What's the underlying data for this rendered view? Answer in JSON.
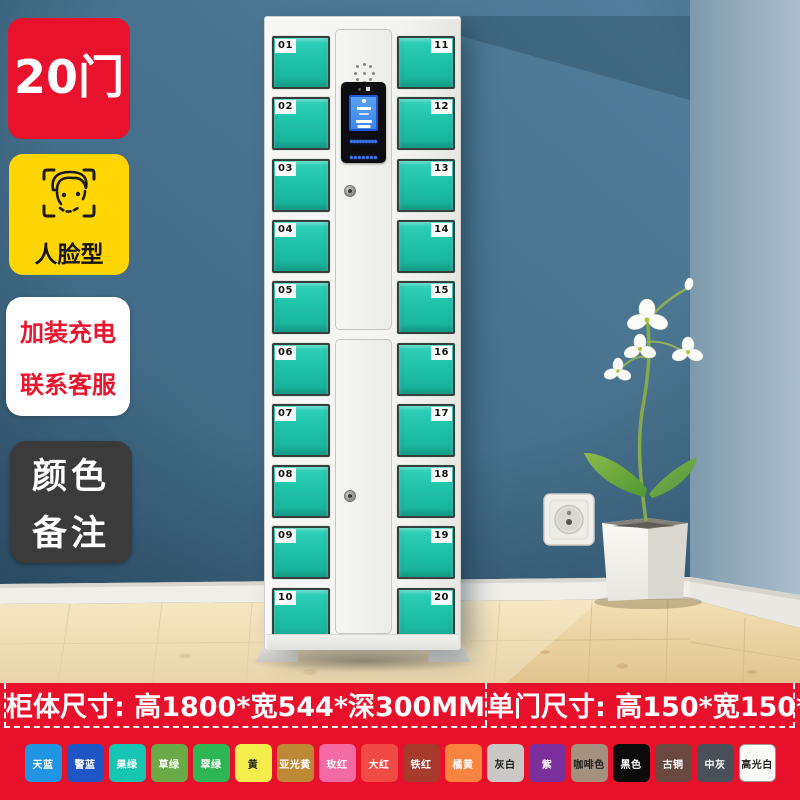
{
  "badges": {
    "door_count": "20门",
    "face_type": "人脸型",
    "service_line1": "加装充电",
    "service_line2": "联系客服",
    "color_note_line1": "颜色",
    "color_note_line2": "备注"
  },
  "locker": {
    "left_door_numbers": [
      "01",
      "02",
      "03",
      "04",
      "05",
      "06",
      "07",
      "08",
      "09",
      "10"
    ],
    "right_door_numbers": [
      "11",
      "12",
      "13",
      "14",
      "15",
      "16",
      "17",
      "18",
      "19",
      "20"
    ],
    "door_color": "#1FC3AA",
    "screen_color": "#4E9AF2",
    "keypad_rows": 4,
    "keypad_cols": 4
  },
  "size_banner": {
    "background_color": "#E8112C",
    "cabinet_size": "柜体尺寸: 高1800*宽544*深300MM",
    "door_size": "单门尺寸: 高150*宽150*深300MM"
  },
  "color_options": [
    {
      "name": "天蓝",
      "hex": "#2095E2",
      "text": "#FFFFFF"
    },
    {
      "name": "警蓝",
      "hex": "#1D55C4",
      "text": "#FFFFFF"
    },
    {
      "name": "果绿",
      "hex": "#16C5B2",
      "text": "#FFFFFF"
    },
    {
      "name": "草绿",
      "hex": "#6BAB47",
      "text": "#FFFFFF"
    },
    {
      "name": "翠绿",
      "hex": "#2EB654",
      "text": "#FFFFFF"
    },
    {
      "name": "黄",
      "hex": "#F3EE4B",
      "text": "#222222"
    },
    {
      "name": "亚光黄",
      "hex": "#BE8937",
      "text": "#FFFFFF"
    },
    {
      "name": "玫红",
      "hex": "#F46AA5",
      "text": "#FFFFFF"
    },
    {
      "name": "大红",
      "hex": "#EF4B44",
      "text": "#FFFFFF"
    },
    {
      "name": "铁红",
      "hex": "#A63B2B",
      "text": "#FFFFFF"
    },
    {
      "name": "橘黄",
      "hex": "#F98440",
      "text": "#FFFFFF"
    },
    {
      "name": "灰白",
      "hex": "#C9C8C5",
      "text": "#222222"
    },
    {
      "name": "紫",
      "hex": "#7A2F9C",
      "text": "#FFFFFF"
    },
    {
      "name": "咖啡色",
      "hex": "#A5907D",
      "text": "#222222"
    },
    {
      "name": "黑色",
      "hex": "#0B0B0B",
      "text": "#FFFFFF"
    },
    {
      "name": "古铜",
      "hex": "#6A4A40",
      "text": "#FFFFFF"
    },
    {
      "name": "中灰",
      "hex": "#49505A",
      "text": "#FFFFFF"
    },
    {
      "name": "高光白",
      "hex": "#FAFAF6",
      "text": "#222222",
      "border": "#9A9A96"
    }
  ]
}
